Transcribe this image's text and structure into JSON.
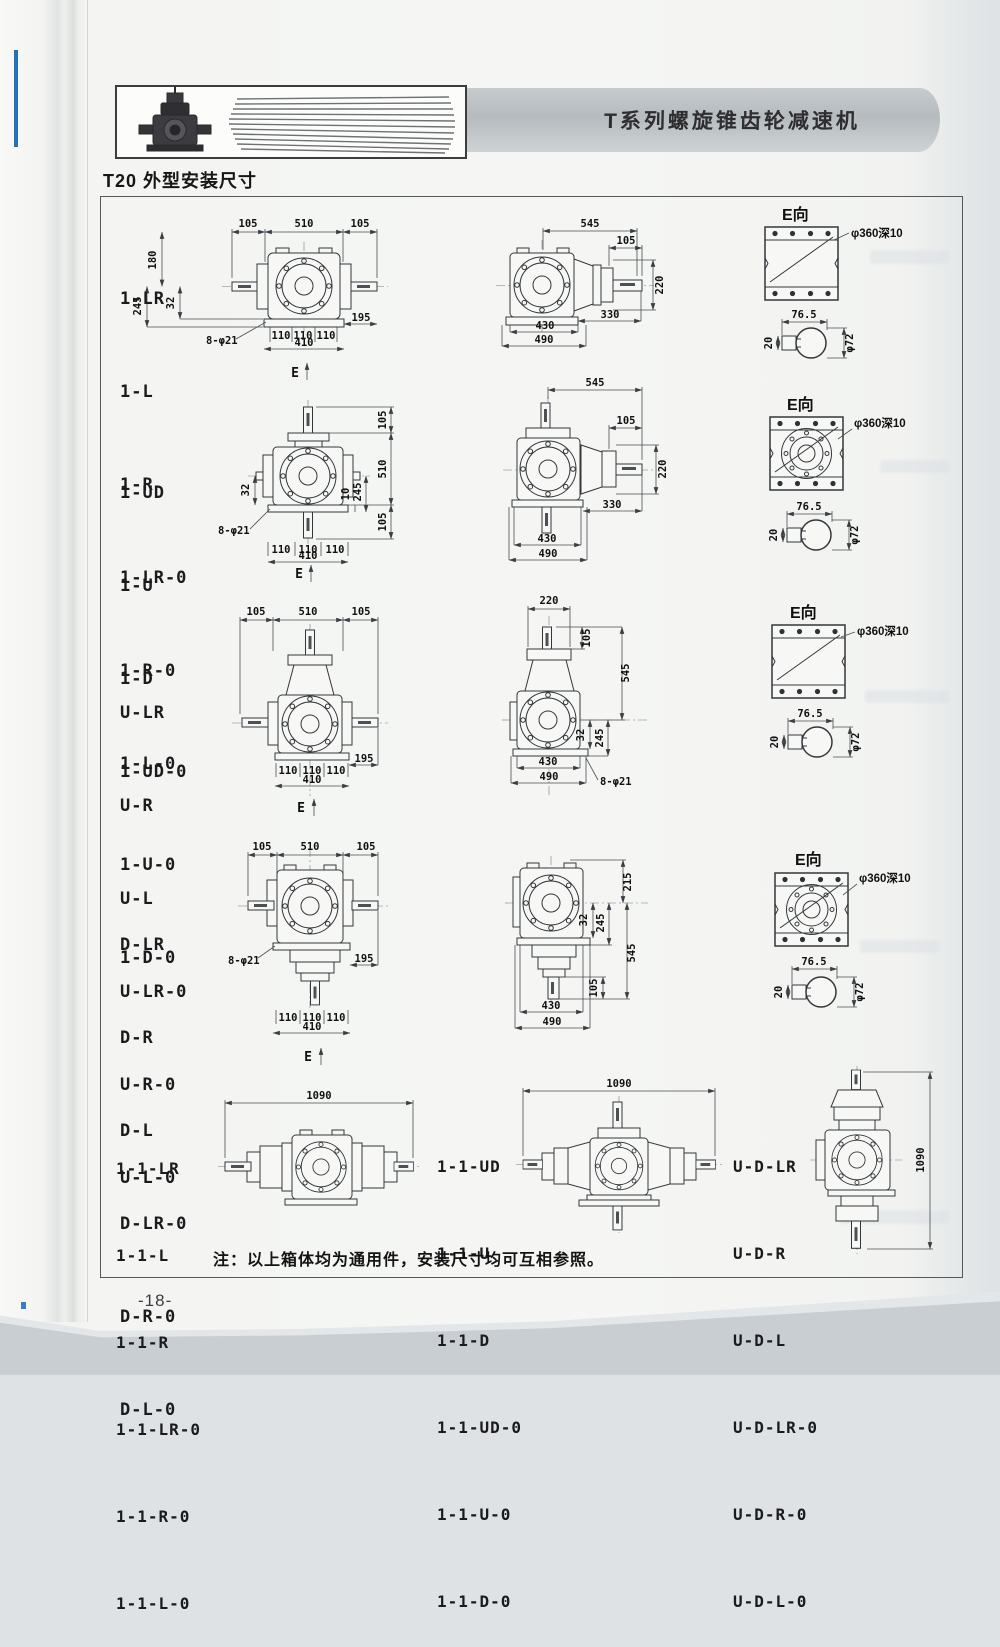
{
  "page": {
    "banner_title": "T系列螺旋锥齿轮减速机",
    "section_title": "T20 外型安装尺寸",
    "note": "注：以上箱体均为通用件，安装尺寸均可互相参照。",
    "page_number": "-18-"
  },
  "rows": [
    {
      "models": [
        "1-LR",
        "1-L",
        "1-R",
        "1-LR-0",
        "1-R-0",
        "1-L-0"
      ],
      "front": {
        "top_left": "105",
        "top_mid": "510",
        "top_right": "105",
        "left_180": "180",
        "left_245": "245",
        "left_32": "32",
        "foot_195": "195",
        "pitch_1": "110",
        "pitch_2": "110",
        "pitch_3": "110",
        "overall_410": "410",
        "holes": "8-φ21",
        "view_arrow": "E"
      },
      "side": {
        "len_545": "545",
        "len_105": "105",
        "dia_220": "220",
        "len_330": "330",
        "len_430": "430",
        "len_490": "490"
      },
      "eview": {
        "title": "E向",
        "callout": "φ360深10",
        "width_76_5": "76.5",
        "key_20": "20",
        "dia_72": "φ72"
      }
    },
    {
      "models": [
        "1-UD",
        "1-U",
        "1-D",
        "1-UD-0",
        "1-U-0",
        "1-D-0"
      ],
      "front": {
        "right_105t": "105",
        "right_510": "510",
        "right_105b": "105",
        "mid_245": "245",
        "mid_10": "10",
        "left_32": "32",
        "pitch_1": "110",
        "pitch_2": "110",
        "pitch_3": "110",
        "overall_410": "410",
        "holes": "8-φ21",
        "view_arrow": "E"
      },
      "side": {
        "len_545": "545",
        "len_105": "105",
        "dia_220": "220",
        "len_330": "330",
        "len_430": "430",
        "len_490": "490"
      },
      "eview": {
        "title": "E向",
        "callout": "φ360深10",
        "width_76_5": "76.5",
        "key_20": "20",
        "dia_72": "φ72"
      }
    },
    {
      "models": [
        "U-LR",
        "U-R",
        "U-L",
        "U-LR-0",
        "U-R-0",
        "U-L-0"
      ],
      "front": {
        "top_left": "105",
        "top_mid": "510",
        "top_right": "105",
        "foot_195": "195",
        "pitch_1": "110",
        "pitch_2": "110",
        "pitch_3": "110",
        "overall_410": "410",
        "view_arrow": "E"
      },
      "side": {
        "top_220": "220",
        "len_105": "105",
        "len_545": "545",
        "off_32": "32",
        "off_245": "245",
        "len_430": "430",
        "len_490": "490",
        "holes": "8-φ21"
      },
      "eview": {
        "title": "E向",
        "callout": "φ360深10",
        "width_76_5": "76.5",
        "key_20": "20",
        "dia_72": "φ72"
      }
    },
    {
      "models": [
        "D-LR",
        "D-R",
        "D-L",
        "D-LR-0",
        "D-R-0",
        "D-L-0"
      ],
      "front": {
        "top_left": "105",
        "top_mid": "510",
        "top_right": "105",
        "holes": "8-φ21",
        "foot_195": "195",
        "pitch_1": "110",
        "pitch_2": "110",
        "pitch_3": "110",
        "overall_410": "410",
        "view_arrow": "E"
      },
      "side": {
        "top_215": "215",
        "off_32": "32",
        "off_245": "245",
        "len_545": "545",
        "len_105": "105",
        "len_430": "430",
        "len_490": "490"
      },
      "eview": {
        "title": "E向",
        "callout": "φ360深10",
        "width_76_5": "76.5",
        "key_20": "20",
        "dia_72": "φ72"
      }
    }
  ],
  "bottom": {
    "groups": [
      {
        "models": [
          "1-1-LR",
          "1-1-L",
          "1-1-R",
          "1-1-LR-0",
          "1-1-R-0",
          "1-1-L-0"
        ],
        "dim_1090": "1090"
      },
      {
        "models": [
          "1-1-UD",
          "1-1-U",
          "1-1-D",
          "1-1-UD-0",
          "1-1-U-0",
          "1-1-D-0"
        ],
        "dim_1090": "1090"
      },
      {
        "models": [
          "U-D-LR",
          "U-D-R",
          "U-D-L",
          "U-D-LR-0",
          "U-D-R-0",
          "U-D-L-0"
        ],
        "dim_1090": "1090"
      }
    ]
  }
}
